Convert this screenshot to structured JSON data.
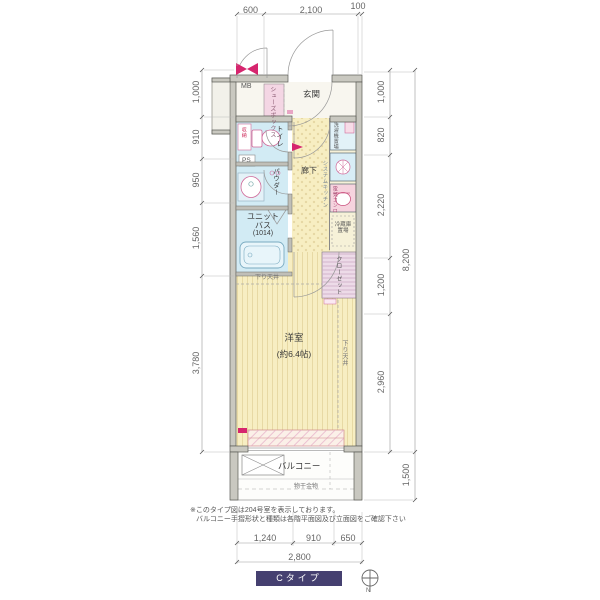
{
  "plan": {
    "rooms": {
      "mb": "MB",
      "entrance": "玄関",
      "shoe_box": "シューズボックス",
      "toilet": "トイレ",
      "storage_small": "収納",
      "ps": "PS",
      "powder": "パウダー",
      "unit_bath_l1": "ユニット",
      "unit_bath_l2": "バス",
      "unit_bath_l3": "(1014)",
      "hallway": "廊下",
      "washer": "洗濯機置場",
      "system_kitchen": "システムキッチン",
      "stove": "電気コンロ",
      "fridge_l1": "冷蔵庫",
      "fridge_l2": "置場",
      "closet": "クローゼット",
      "lowered_ceiling": "下り天井",
      "room_l1": "洋室",
      "room_l2": "(約6.4帖)",
      "balcony": "バルコニー",
      "drying_fixture": "物干金物"
    },
    "colors": {
      "wall": "#c9c8c0",
      "water_room": "#d2ebf4",
      "floor_yellow": "#f7eec2",
      "pink_box": "#f4d6e4",
      "accent_magenta": "#d6256e",
      "banner_navy": "#454070"
    }
  },
  "dimensions": {
    "top": [
      "600",
      "2,100",
      "100"
    ],
    "left": [
      "1,000",
      "910",
      "950",
      "1,560",
      "3,780"
    ],
    "right_inner": [
      "1,000",
      "820",
      "2,220",
      "1,200",
      "2,960"
    ],
    "right_outer": [
      "8,200",
      "1,500"
    ],
    "bottom": [
      "1,240",
      "910",
      "650"
    ],
    "bottom_total": "2,800"
  },
  "notes": {
    "line1": "※このタイプ図は204号室を表示しております。",
    "line2": "バルコニー手摺形状と種類は各階平面図及び立面図をご確認下さい"
  },
  "footer": {
    "type_label": "Cタイプ",
    "north": "N"
  }
}
